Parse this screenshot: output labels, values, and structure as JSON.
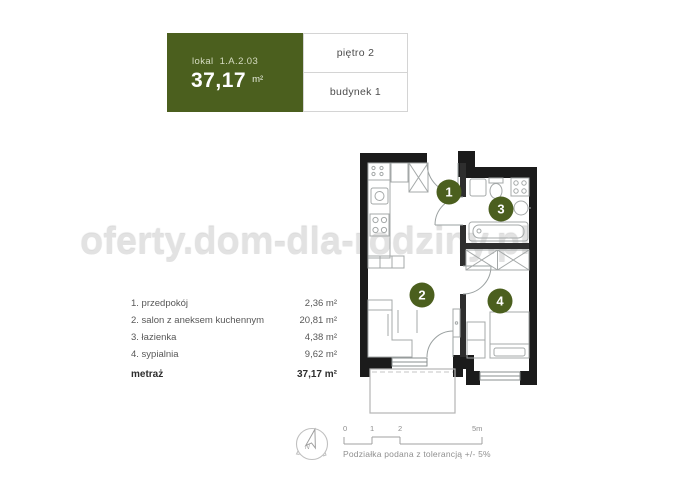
{
  "header": {
    "lokal_label": "lokal 1.A.2.03",
    "area_value": "37,17",
    "area_unit": "m²",
    "floor_label": "piętro 2",
    "building_label": "budynek 1"
  },
  "watermark_text": "oferty.dom-dla-rodziny.pl",
  "legend": {
    "rows": [
      {
        "name": "1. przedpokój",
        "area": "2,36 m²"
      },
      {
        "name": "2. salon z aneksem kuchennym",
        "area": "20,81 m²"
      },
      {
        "name": "3. łazienka",
        "area": "4,38 m²"
      },
      {
        "name": "4. sypialnia",
        "area": "9,62 m²"
      }
    ],
    "total_label": "metraż",
    "total_area": "37,17 m²"
  },
  "plan": {
    "room_numbers": [
      "1",
      "2",
      "3",
      "4"
    ],
    "compass_north_label": "N"
  },
  "scale_bar": {
    "ticks": [
      "0",
      "1",
      "2",
      "5m"
    ],
    "tolerance_note": "Podziałka podana z tolerancją +/- 5%"
  },
  "colors": {
    "accent_green": "#4b5f1e",
    "wall_black": "#1b1b1b",
    "furniture_gray": "#a4a8a8",
    "watermark_gray": "#e2e2e2"
  }
}
